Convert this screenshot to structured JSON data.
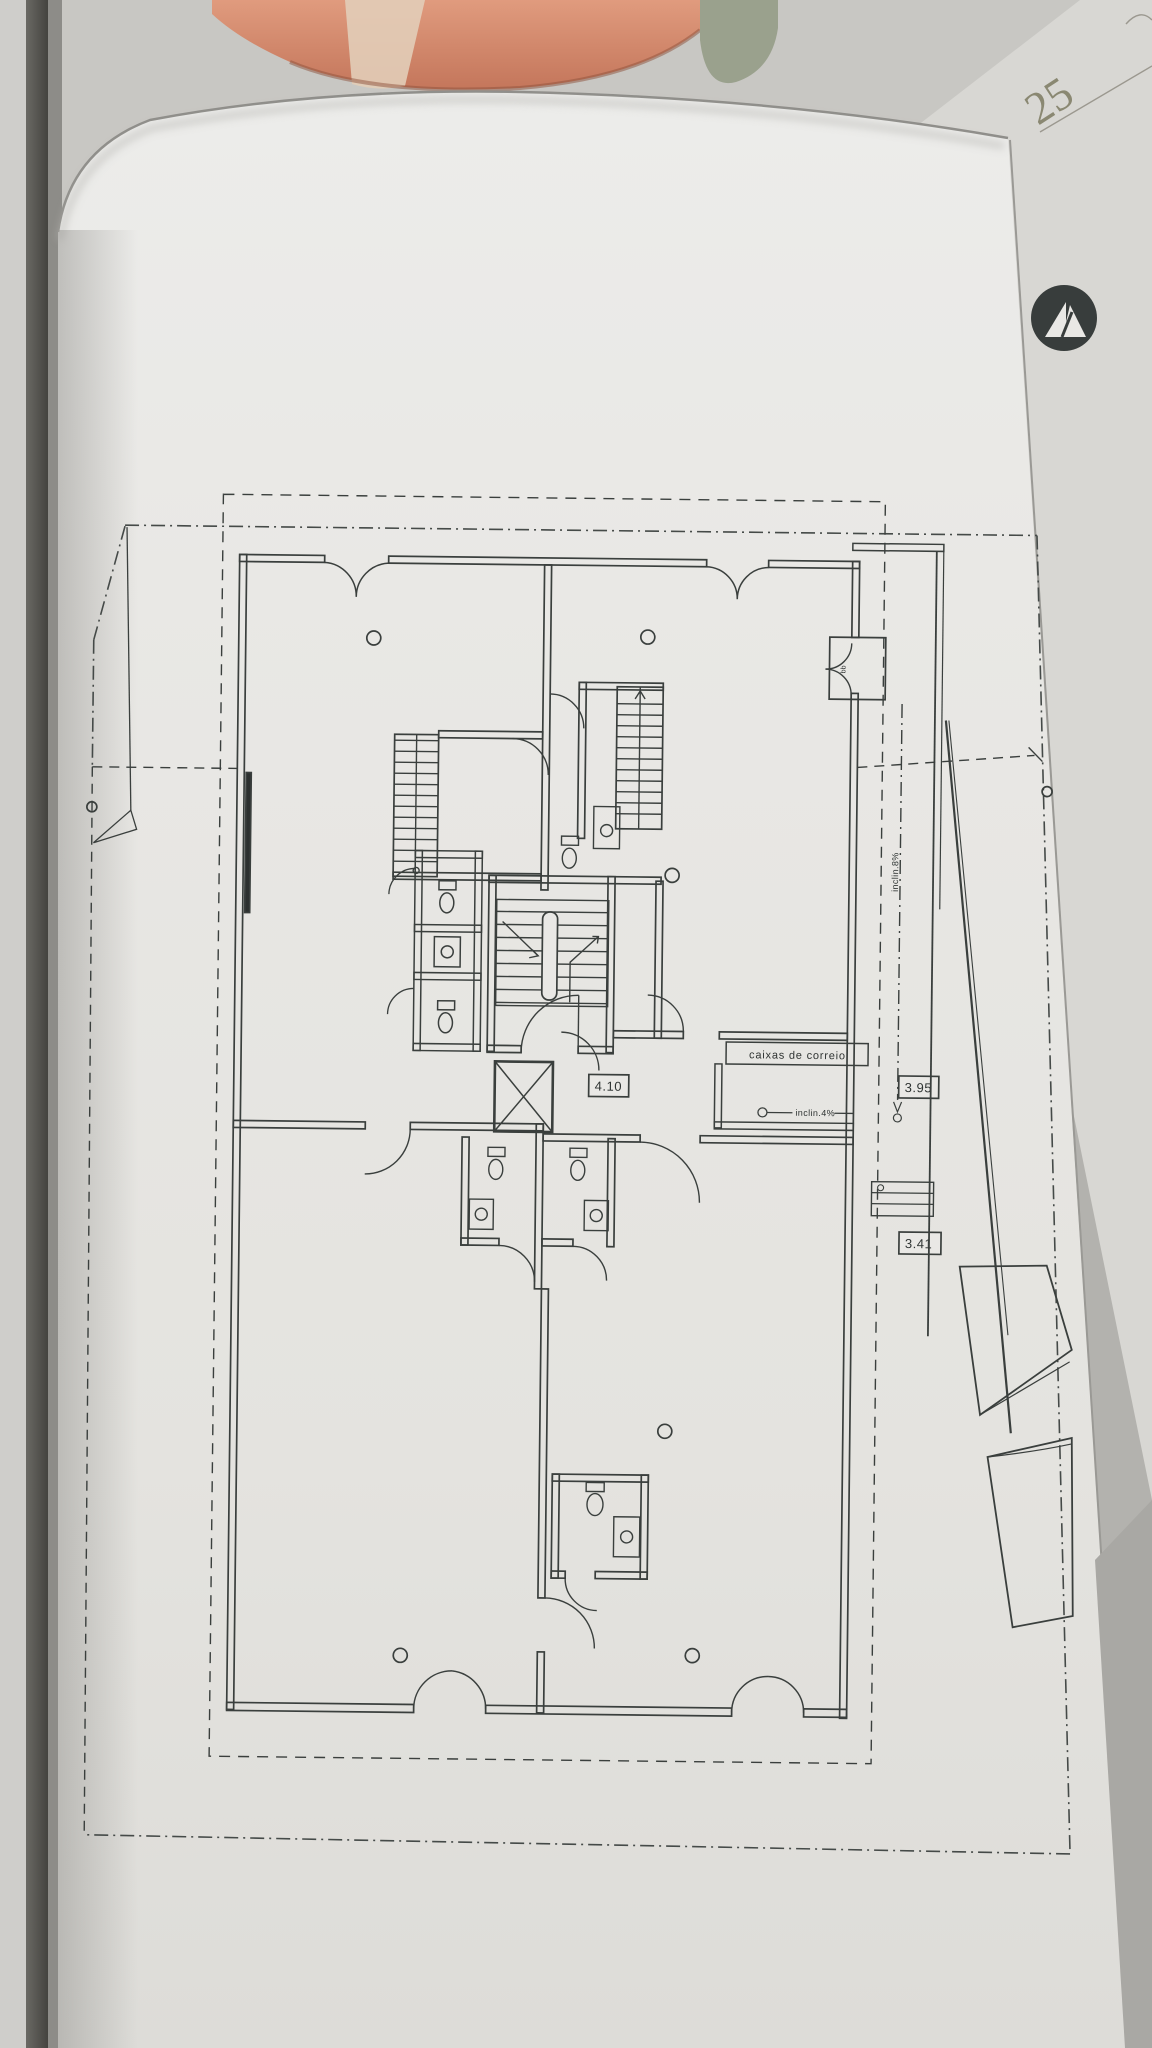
{
  "sheet": {
    "corner_number": "25",
    "labels": {
      "mailboxes": "caixas de correio",
      "entry_slope": "inclin.4%",
      "ramp_slope": "inclin.8%",
      "closet_marker": "bb"
    },
    "dimensions": {
      "hall_width": "4.10",
      "entry_width": "3.95",
      "stair_width": "3.41"
    },
    "colors": {
      "ink": "#3a3f3d",
      "paper": "#e9e8e5",
      "logo": "#383d3c",
      "background": "#b3b2ae"
    }
  }
}
